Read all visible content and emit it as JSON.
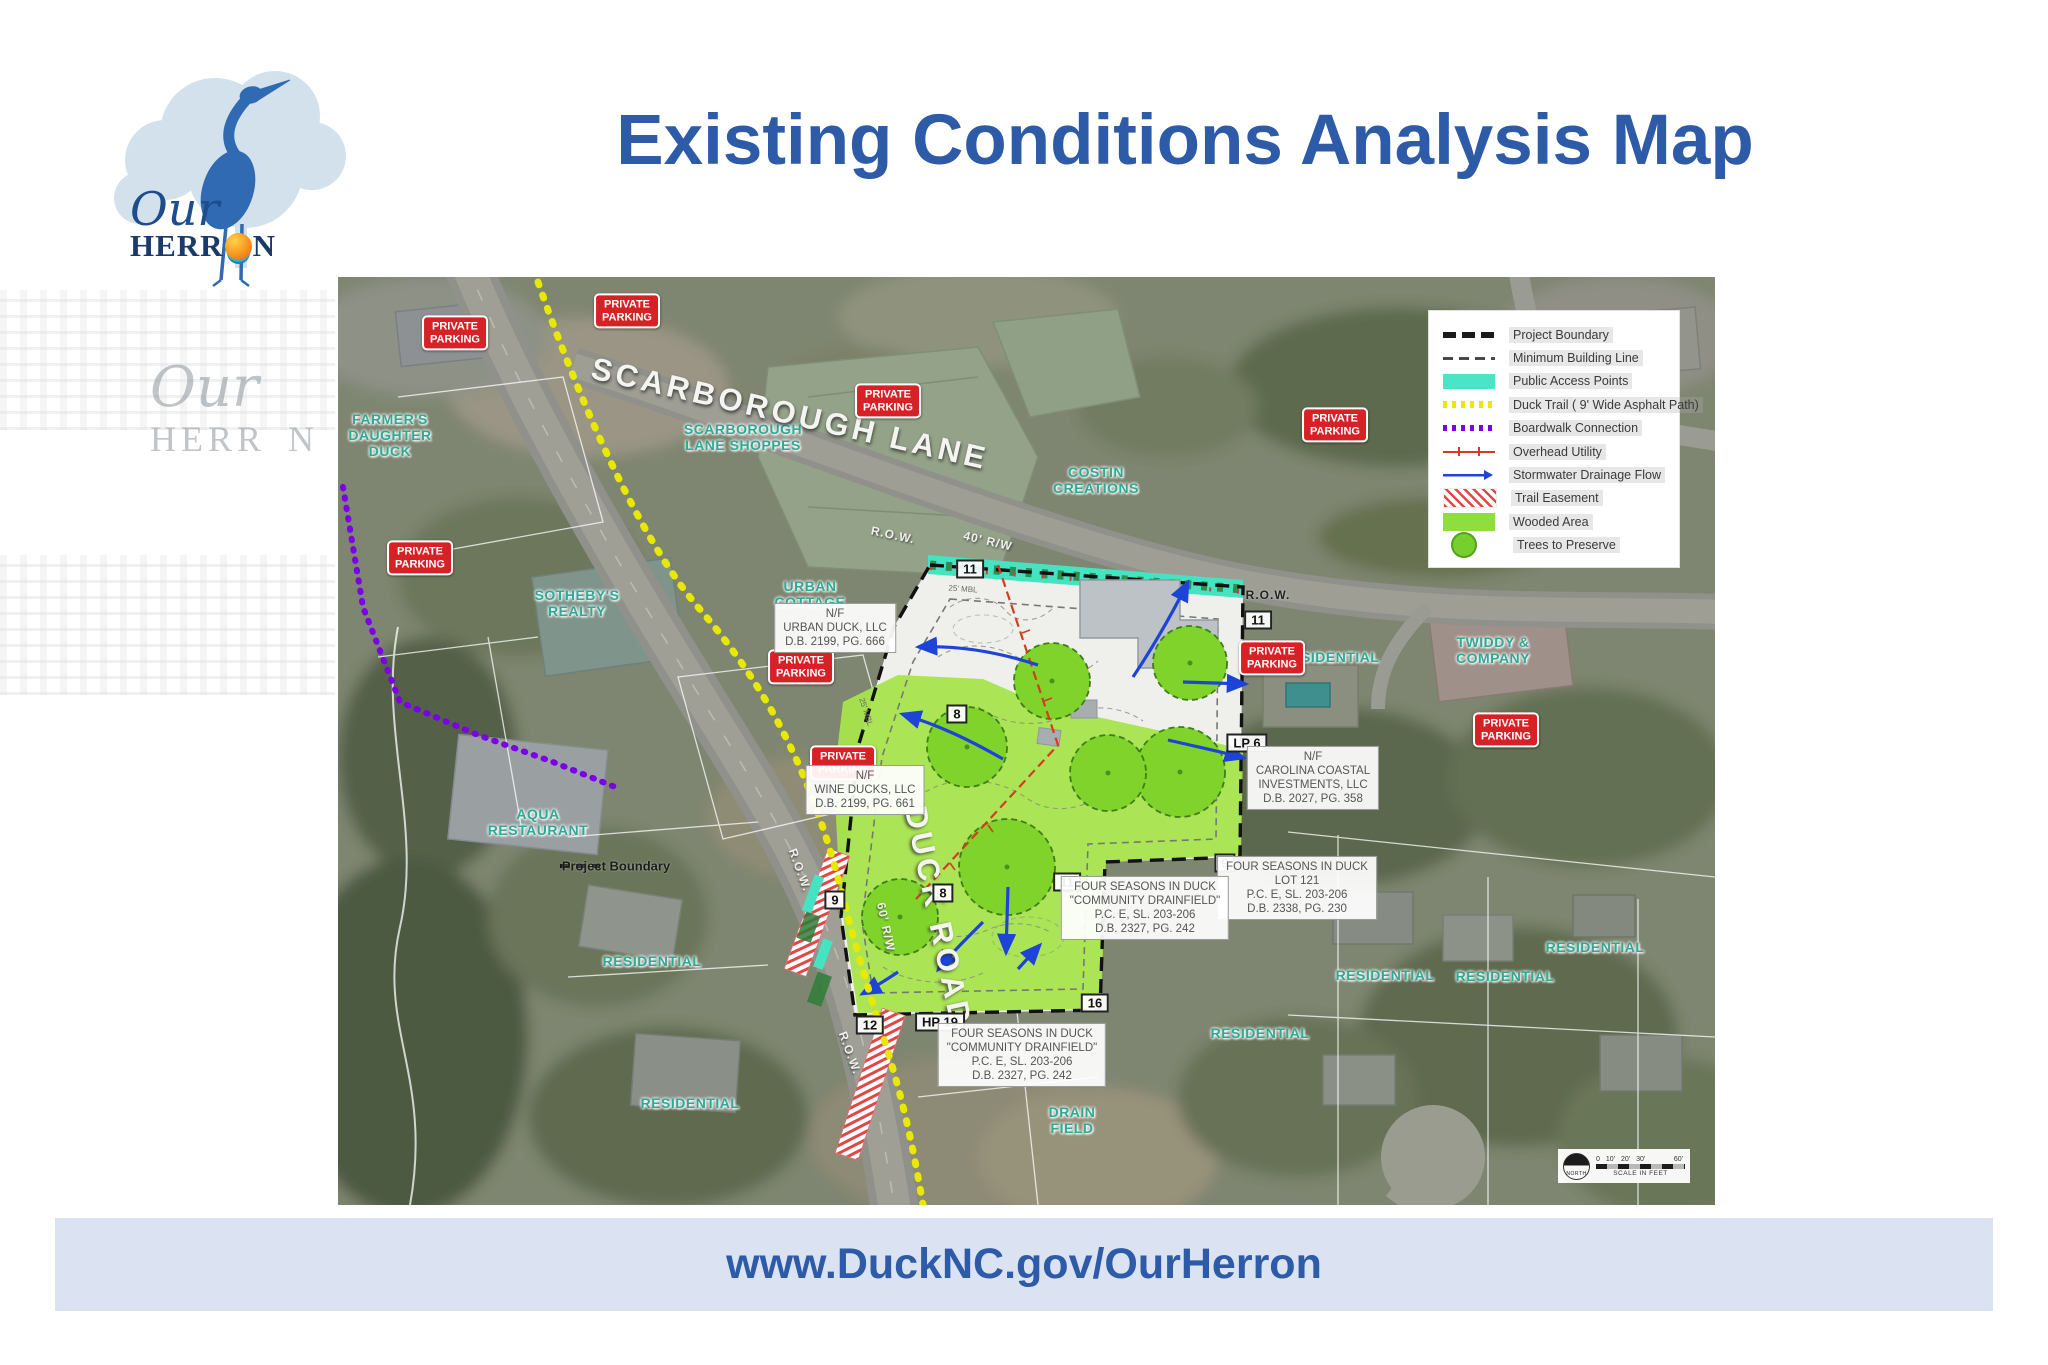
{
  "header": {
    "title": "Existing Conditions Analysis Map",
    "logo": {
      "script_word": "Our",
      "caps_prefix": "HERR",
      "caps_suffix": "N",
      "sun_icon": "sun-over-waves"
    }
  },
  "ghost_artifact": {
    "script_word": "Our",
    "caps_word": "HERR N"
  },
  "footer": {
    "url": "www.DuckNC.gov/OurHerron"
  },
  "colors": {
    "accent_blue": "#2d5ba7",
    "footer_bg": "#dbe2f2",
    "place_label_teal": "#2fa894",
    "badge_red": "#d62127",
    "public_access_cyan": "#4ae4c6",
    "trail_yellow": "#e8e800",
    "boardwalk_purple": "#7b00e6",
    "wooded_green": "#a8e34d",
    "tree_green": "#76cf2d",
    "utility_red": "#d33a1f",
    "stormwater_blue": "#1d44d7"
  },
  "map": {
    "legend": {
      "items": [
        {
          "key": "project-boundary",
          "sym": "dash-bold",
          "label": "Project Boundary"
        },
        {
          "key": "minimum-building-line",
          "sym": "dash-thin",
          "label": "Minimum Building Line"
        },
        {
          "key": "public-access-points",
          "sym": "rect-cyan",
          "label": "Public Access Points"
        },
        {
          "key": "duck-trail",
          "sym": "dots-yellow",
          "label": "Duck Trail ( 9' Wide Asphalt Path)"
        },
        {
          "key": "boardwalk-connection",
          "sym": "dots-purple",
          "label": "Boardwalk Connection"
        },
        {
          "key": "overhead-utility",
          "sym": "line-red",
          "label": "Overhead Utility"
        },
        {
          "key": "stormwater-drainage",
          "sym": "arrow-blue",
          "label": "Stormwater Drainage Flow"
        },
        {
          "key": "trail-easement",
          "sym": "hatch-red",
          "label": "Trail Easement"
        },
        {
          "key": "wooded-area",
          "sym": "rect-green",
          "label": "Wooded Area"
        },
        {
          "key": "trees-to-preserve",
          "sym": "circle-green",
          "label": "Trees to Preserve"
        }
      ]
    },
    "badge_text": "PRIVATE\nPARKING",
    "badges": [
      [
        117,
        56
      ],
      [
        289,
        34
      ],
      [
        550,
        124
      ],
      [
        997,
        148
      ],
      [
        82,
        281
      ],
      [
        463,
        390
      ],
      [
        505,
        486
      ],
      [
        934,
        381
      ],
      [
        1168,
        453
      ]
    ],
    "markers": [
      {
        "t": "11",
        "x": 632,
        "y": 292
      },
      {
        "t": "11",
        "x": 920,
        "y": 343
      },
      {
        "t": "11",
        "x": 729,
        "y": 605
      },
      {
        "t": "8",
        "x": 619,
        "y": 437
      },
      {
        "t": "8",
        "x": 605,
        "y": 616
      },
      {
        "t": "9",
        "x": 497,
        "y": 623
      },
      {
        "t": "9",
        "x": 887,
        "y": 586
      },
      {
        "t": "12",
        "x": 532,
        "y": 748
      },
      {
        "t": "16",
        "x": 757,
        "y": 726
      },
      {
        "t": "LP 6",
        "x": 909,
        "y": 466
      },
      {
        "t": "HP 19",
        "x": 602,
        "y": 745
      }
    ],
    "parcel_notes": [
      {
        "x": 497,
        "y": 351,
        "lines": [
          "N/F",
          "URBAN DUCK, LLC",
          "D.B. 2199, PG. 666"
        ]
      },
      {
        "x": 527,
        "y": 513,
        "lines": [
          "N/F",
          "WINE DUCKS, LLC",
          "D.B. 2199, PG. 661"
        ]
      },
      {
        "x": 975,
        "y": 501,
        "lines": [
          "N/F",
          "CAROLINA COASTAL",
          "INVESTMENTS, LLC",
          "D.B. 2027, PG. 358"
        ]
      },
      {
        "x": 959,
        "y": 611,
        "lines": [
          "FOUR SEASONS IN DUCK",
          "LOT 121",
          "P.C. E, SL. 203-206",
          "D.B. 2338, PG. 230"
        ]
      },
      {
        "x": 807,
        "y": 631,
        "lines": [
          "FOUR SEASONS IN DUCK",
          "\"COMMUNITY DRAINFIELD\"",
          "P.C. E, SL. 203-206",
          "D.B. 2327, PG. 242"
        ]
      },
      {
        "x": 684,
        "y": 778,
        "lines": [
          "FOUR SEASONS IN DUCK",
          "\"COMMUNITY DRAINFIELD\"",
          "P.C. E, SL. 203-206",
          "D.B. 2327, PG. 242"
        ]
      }
    ],
    "text_labels": [
      {
        "t": "FARMER'S\nDAUGHTER\nDUCK",
        "x": 52,
        "y": 158,
        "c": "teal",
        "n": "place-label-farmers-daughter-duck"
      },
      {
        "t": "SCARBOROUGH\nLANE SHOPPES",
        "x": 405,
        "y": 160,
        "c": "teal",
        "n": "place-label-scarborough-lane-shoppes"
      },
      {
        "t": "COSTIN\nCREATIONS",
        "x": 758,
        "y": 203,
        "c": "teal",
        "n": "place-label-costin-creations"
      },
      {
        "t": "URBAN\nCOTTAGE",
        "x": 472,
        "y": 317,
        "c": "teal",
        "n": "place-label-urban-cottage"
      },
      {
        "t": "SOTHEBY'S\nREALTY",
        "x": 239,
        "y": 326,
        "c": "teal",
        "n": "place-label-sothebys-realty"
      },
      {
        "t": "AQUA\nRESTAURANT",
        "x": 200,
        "y": 545,
        "c": "teal",
        "n": "place-label-aqua-restaurant"
      },
      {
        "t": "TWIDDY &\nCOMPANY",
        "x": 1155,
        "y": 373,
        "c": "teal",
        "n": "place-label-twiddy-company"
      },
      {
        "t": "RESIDENTIAL",
        "x": 992,
        "y": 380,
        "c": "teal",
        "n": "place-label-residential"
      },
      {
        "t": "RESIDENTIAL",
        "x": 314,
        "y": 684,
        "c": "teal",
        "n": "place-label-residential"
      },
      {
        "t": "RESIDENTIAL",
        "x": 352,
        "y": 826,
        "c": "teal",
        "n": "place-label-residential"
      },
      {
        "t": "RESIDENTIAL",
        "x": 1047,
        "y": 698,
        "c": "teal",
        "n": "place-label-residential"
      },
      {
        "t": "RESIDENTIAL",
        "x": 1167,
        "y": 699,
        "c": "teal",
        "n": "place-label-residential"
      },
      {
        "t": "RESIDENTIAL",
        "x": 1257,
        "y": 670,
        "c": "teal",
        "n": "place-label-residential"
      },
      {
        "t": "RESIDENTIAL",
        "x": 922,
        "y": 756,
        "c": "teal",
        "n": "place-label-residential"
      },
      {
        "t": "DRAIN\nFIELD",
        "x": 734,
        "y": 843,
        "c": "teal",
        "n": "place-label-drain-field"
      },
      {
        "t": "SCARBOROUGH LANE",
        "x": 452,
        "y": 137,
        "r": 13,
        "c": "road-big",
        "n": "road-label-scarborough-lane"
      },
      {
        "t": "40' R/W",
        "x": 650,
        "y": 264,
        "r": 13,
        "c": "row",
        "n": "road-width-label"
      },
      {
        "t": "DUCK ROAD",
        "x": 600,
        "y": 640,
        "r": 78,
        "c": "road-big",
        "n": "road-label-duck-road"
      },
      {
        "t": "60' R/W",
        "x": 548,
        "y": 650,
        "r": 78,
        "c": "row",
        "n": "road-width-label"
      },
      {
        "t": "R.O.W.",
        "x": 555,
        "y": 258,
        "r": 12,
        "c": "row",
        "n": "row-label"
      },
      {
        "t": "R.O.W.",
        "x": 930,
        "y": 318,
        "r": 0,
        "c": "row-dark",
        "n": "row-label"
      },
      {
        "t": "R.O.W.",
        "x": 462,
        "y": 593,
        "r": 70,
        "c": "row",
        "n": "row-label"
      },
      {
        "t": "R.O.W.",
        "x": 512,
        "y": 776,
        "r": 70,
        "c": "row",
        "n": "row-label"
      },
      {
        "t": "Project Boundary",
        "x": 278,
        "y": 589,
        "c": "black",
        "n": "project-boundary-label"
      },
      {
        "t": "25' MBL",
        "x": 625,
        "y": 312,
        "r": 4,
        "c": "tiny",
        "n": "mbl-label"
      },
      {
        "t": "25' MBL",
        "x": 528,
        "y": 435,
        "r": 72,
        "c": "tiny",
        "n": "mbl-label"
      }
    ],
    "scale_bar": {
      "north": "NORTH",
      "ticks": [
        "0",
        "10'",
        "20'",
        "30'",
        "60'"
      ],
      "caption": "SCALE IN FEET"
    }
  }
}
